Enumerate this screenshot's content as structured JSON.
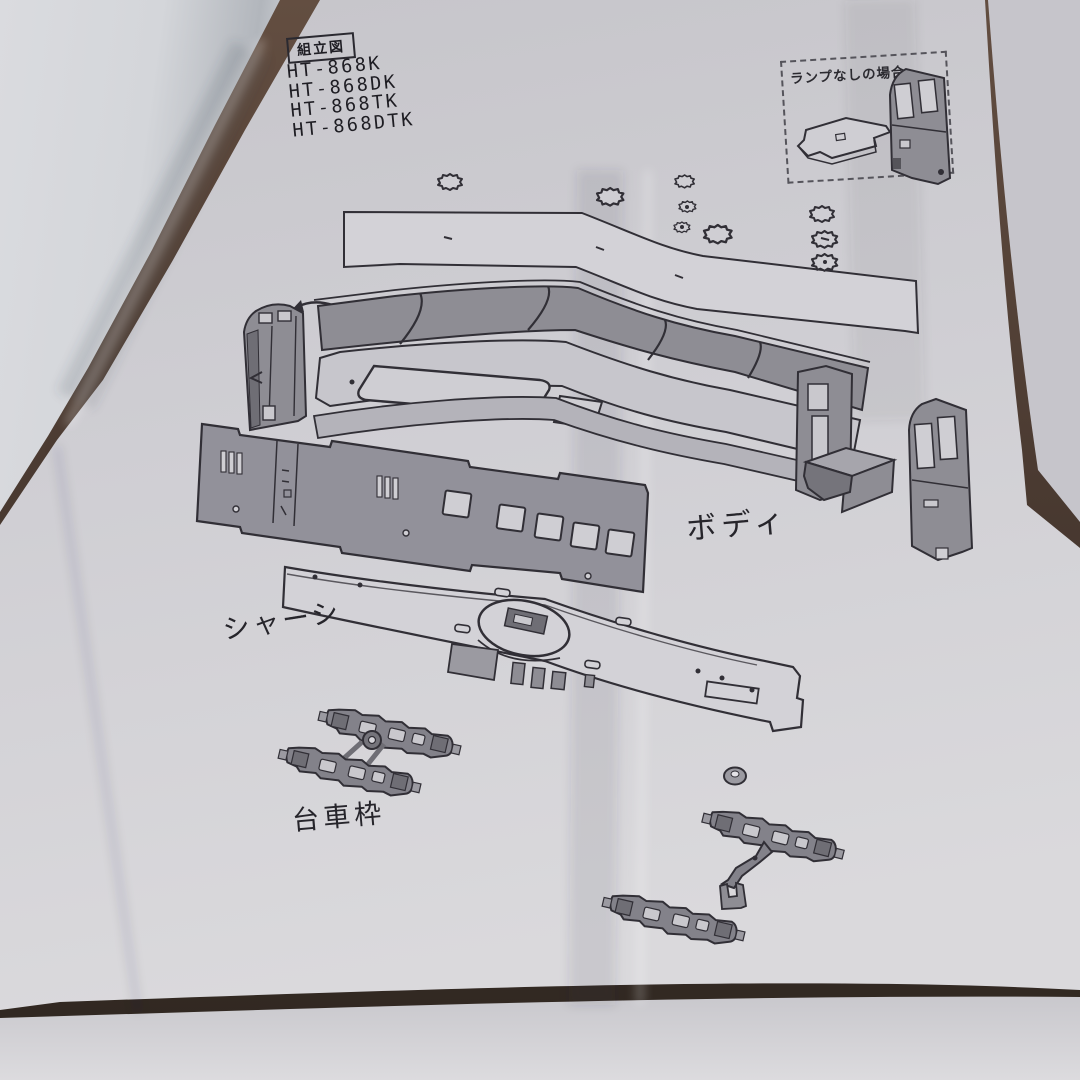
{
  "photo": {
    "background_color": "#4a3a31",
    "main_sheet_color": "#cfced3",
    "left_page_color": "#d8dade",
    "bottom_page_color": "#d4d3d7",
    "right_page_color": "#c6c5cb",
    "ink_color": "#312f36"
  },
  "sheet": {
    "title": "組立図",
    "model_numbers": [
      "HT-868K",
      "HT-868DK",
      "HT-868TK",
      "HT-868DTK"
    ],
    "inset": {
      "label": "ランプなしの場合"
    },
    "labels": {
      "body": "ボディ",
      "chassis": "シャーシ",
      "truck_frame": "台車枠"
    }
  }
}
